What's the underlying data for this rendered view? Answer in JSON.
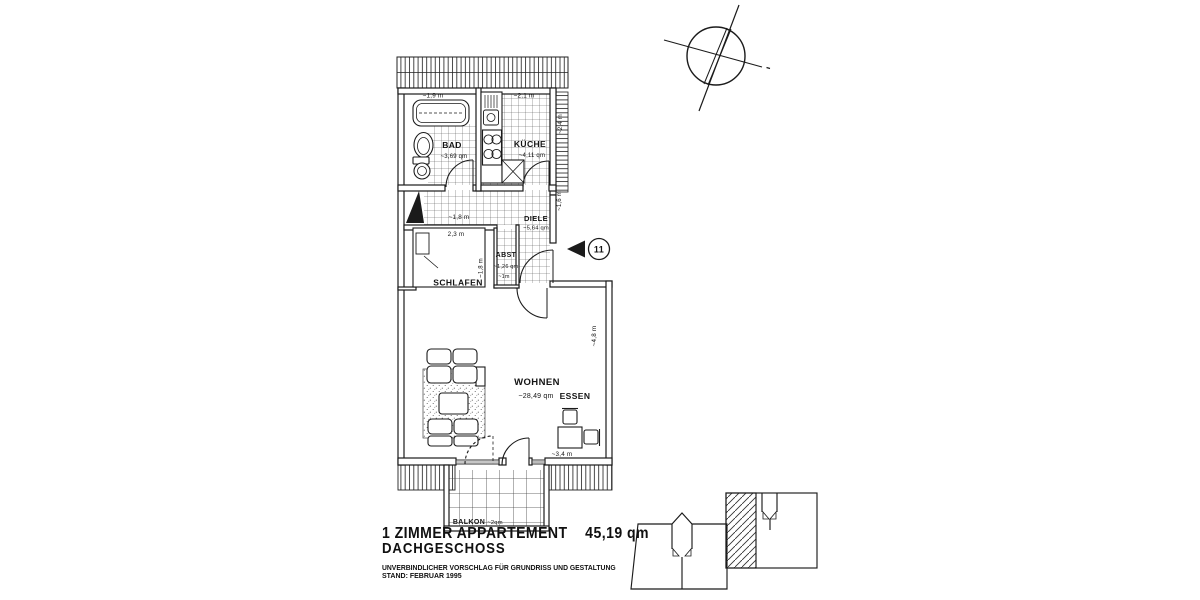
{
  "colors": {
    "ink": "#1b1b1b",
    "paper": "#ffffff"
  },
  "plan": {
    "rooms": {
      "bad": {
        "name": "BAD",
        "area": "~3,69 qm"
      },
      "kueche": {
        "name": "KÜCHE",
        "area": "~4,11 qm"
      },
      "diele": {
        "name": "DIELE",
        "area": "~5,64 qm"
      },
      "abst": {
        "name": "ABST",
        "area": "~1,26 qm",
        "width": "~1m"
      },
      "schlafen": {
        "name": "SCHLAFEN"
      },
      "wohnen": {
        "name": "WOHNEN",
        "area": "~28,49 qm"
      },
      "essen": {
        "name": "ESSEN"
      },
      "balkon": {
        "name": "BALKON",
        "area": "~2qm"
      }
    },
    "dimensions": {
      "bad_width": "~1,9 m",
      "kueche_width": "~2,1 m",
      "kueche_depth": "~2,4 m",
      "flur_width": "~1,8 m",
      "bett_laenge": "2,3 m",
      "bett_breite": "~1,8 m",
      "diele_tiefe": "~1,6 m",
      "wohnen_tiefe": "~4,8 m",
      "wohnen_breite": "~3,4 m"
    },
    "unit_marker": {
      "number": "11"
    }
  },
  "title_block": {
    "title": "1 ZIMMER APPARTEMENT",
    "area_total": "45,19 qm",
    "floor": "DACHGESCHOSS",
    "disclaimer": "UNVERBINDLICHER VORSCHLAG FÜR GRUNDRISS UND  GESTALTUNG",
    "status": "STAND: FEBRUAR 1995"
  }
}
